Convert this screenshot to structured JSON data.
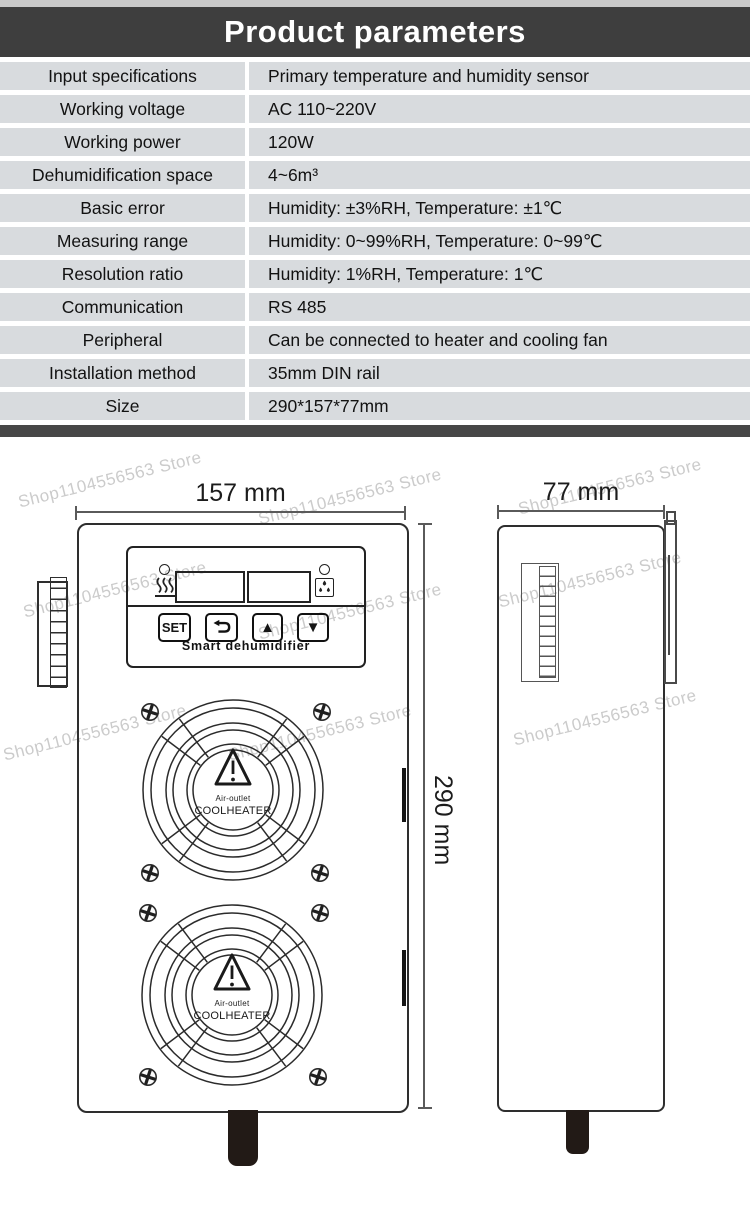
{
  "header": {
    "title": "Product parameters"
  },
  "table": {
    "rows": [
      {
        "label": "Input specifications",
        "value": "Primary temperature and humidity sensor"
      },
      {
        "label": "Working voltage",
        "value": "AC 110~220V"
      },
      {
        "label": "Working power",
        "value": "120W"
      },
      {
        "label": "Dehumidification space",
        "value": "4~6m³"
      },
      {
        "label": "Basic error",
        "value": "Humidity: ±3%RH, Temperature: ±1℃"
      },
      {
        "label": "Measuring range",
        "value": "Humidity: 0~99%RH, Temperature: 0~99℃"
      },
      {
        "label": "Resolution ratio",
        "value": "Humidity: 1%RH, Temperature: 1℃"
      },
      {
        "label": "Communication",
        "value": "RS 485"
      },
      {
        "label": "Peripheral",
        "value": "Can be connected to heater and cooling fan"
      },
      {
        "label": "Installation method",
        "value": "35mm DIN rail"
      },
      {
        "label": "Size",
        "value": "290*157*77mm"
      }
    ]
  },
  "watermark": {
    "text": "Shop1104556563 Store"
  },
  "diagram": {
    "front": {
      "width_label": "157 mm",
      "height_label": "290 mm",
      "panel": {
        "set_button": "SET",
        "up_glyph": "▲",
        "down_glyph": "▼",
        "title": "Smart dehumidifier"
      }
    },
    "side": {
      "width_label": "77 mm"
    },
    "fan": {
      "line1": "Air-outlet",
      "line2": "COOLHEATER"
    }
  },
  "colors": {
    "header_bg": "#3e3e3e",
    "row_bg": "#d8dbde",
    "separator": "#474747",
    "line": "#2e2e2e",
    "tab_black": "#221a16"
  }
}
